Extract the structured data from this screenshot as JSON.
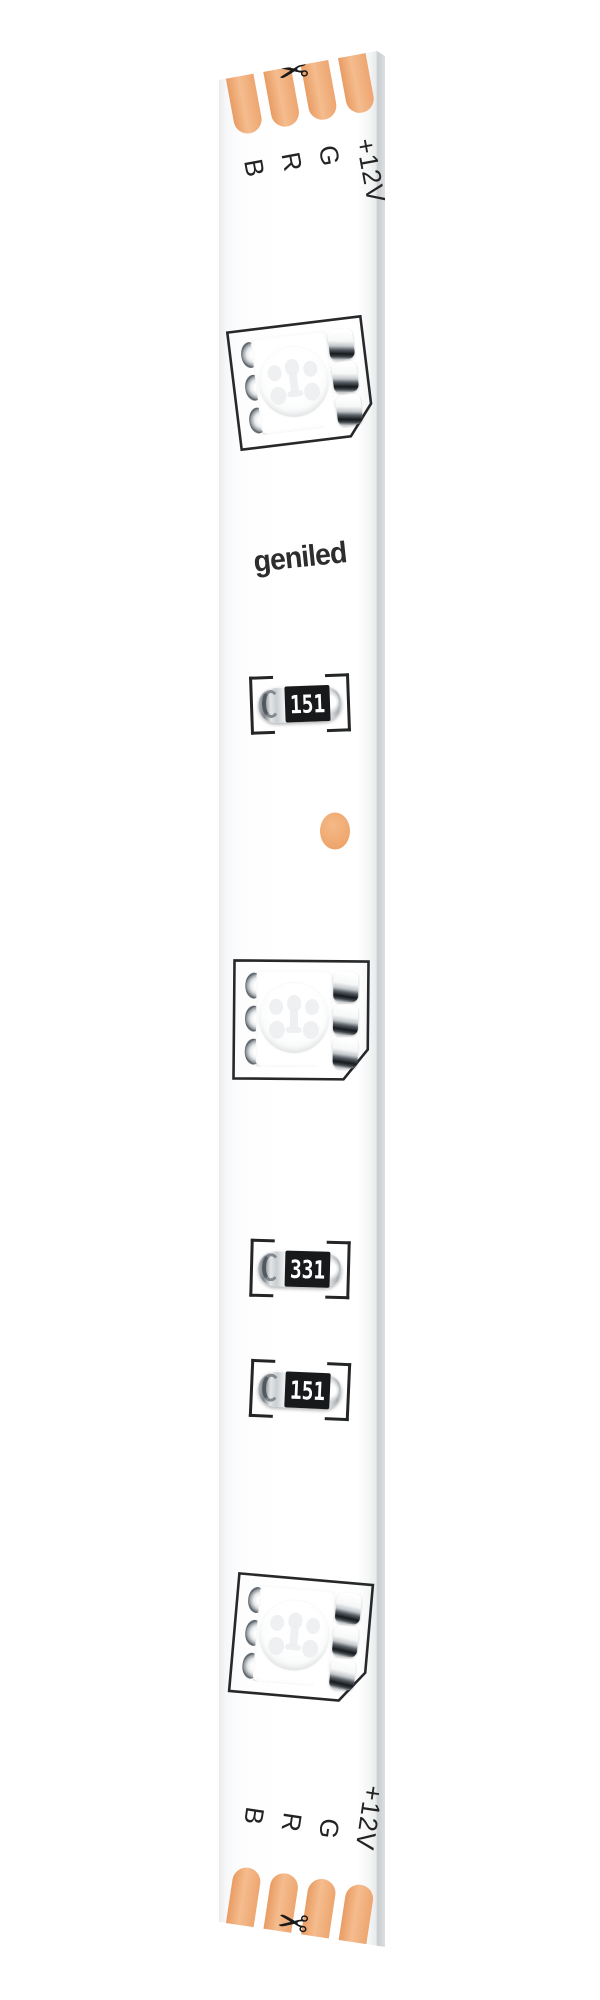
{
  "brand": {
    "logo_text": "geniled"
  },
  "terminals": {
    "top": {
      "pin_labels": [
        "B",
        "R",
        "G",
        "+12V"
      ],
      "pad_count": 4
    },
    "bottom": {
      "pin_labels": [
        "B",
        "R",
        "G",
        "+12V"
      ],
      "pad_count": 4
    }
  },
  "components": {
    "leds": [
      {
        "type": "smd-5050-rgb-led"
      },
      {
        "type": "smd-5050-rgb-led"
      },
      {
        "type": "smd-5050-rgb-led"
      }
    ],
    "resistors": [
      {
        "code": "151"
      },
      {
        "code": "331"
      },
      {
        "code": "151"
      }
    ],
    "solder_dot": {
      "present": true
    }
  },
  "icons": {
    "scissors": "✂"
  },
  "colors": {
    "copper_pad": "#f0ad7a",
    "pcb_white": "#fdfdfe",
    "silkscreen": "#232526",
    "resistor_body": "#17191b",
    "resistor_code_text": "#ffffff",
    "solder_dot": "#f0ab74",
    "edge_shade": "#c9cdcf",
    "brand_text": "#2d2d2d"
  }
}
